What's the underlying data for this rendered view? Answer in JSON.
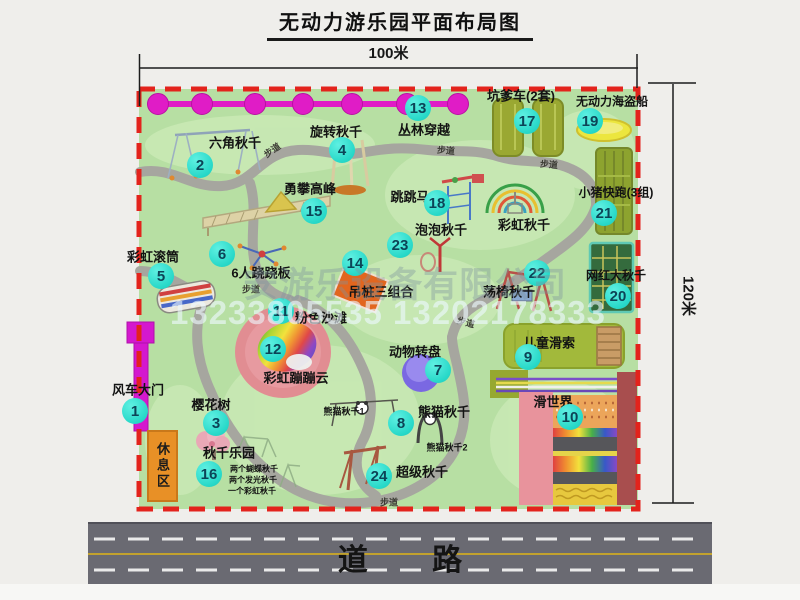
{
  "title": "无动力游乐园平面布局图",
  "dimensions": {
    "width_label": "100米",
    "height_label": "120米"
  },
  "road_label": "道 路",
  "rest_area_label": "休息区",
  "watermark": {
    "company": "安游乐设备有限公司",
    "phone": "13233805535 13202178333"
  },
  "map": {
    "markers": [
      {
        "num": "1",
        "x": 135,
        "y": 411
      },
      {
        "num": "2",
        "x": 200,
        "y": 165
      },
      {
        "num": "3",
        "x": 216,
        "y": 423
      },
      {
        "num": "4",
        "x": 342,
        "y": 150
      },
      {
        "num": "5",
        "x": 161,
        "y": 276
      },
      {
        "num": "6",
        "x": 222,
        "y": 254
      },
      {
        "num": "7",
        "x": 438,
        "y": 370
      },
      {
        "num": "8",
        "x": 401,
        "y": 423
      },
      {
        "num": "9",
        "x": 528,
        "y": 357
      },
      {
        "num": "10",
        "x": 570,
        "y": 417
      },
      {
        "num": "11",
        "x": 281,
        "y": 311
      },
      {
        "num": "12",
        "x": 273,
        "y": 349
      },
      {
        "num": "13",
        "x": 418,
        "y": 108
      },
      {
        "num": "14",
        "x": 355,
        "y": 263
      },
      {
        "num": "15",
        "x": 314,
        "y": 211
      },
      {
        "num": "16",
        "x": 209,
        "y": 474
      },
      {
        "num": "17",
        "x": 527,
        "y": 121
      },
      {
        "num": "18",
        "x": 437,
        "y": 203
      },
      {
        "num": "19",
        "x": 590,
        "y": 121
      },
      {
        "num": "20",
        "x": 618,
        "y": 296
      },
      {
        "num": "21",
        "x": 604,
        "y": 213
      },
      {
        "num": "22",
        "x": 537,
        "y": 273
      },
      {
        "num": "23",
        "x": 400,
        "y": 245
      },
      {
        "num": "24",
        "x": 379,
        "y": 476
      }
    ],
    "labels": [
      {
        "text": "六角秋千",
        "x": 235,
        "y": 142
      },
      {
        "text": "旋转秋千",
        "x": 336,
        "y": 131
      },
      {
        "text": "丛林穿越",
        "x": 424,
        "y": 129
      },
      {
        "text": "坑爹车(2套)",
        "x": 521,
        "y": 95
      },
      {
        "text": "无动力海盗船",
        "x": 612,
        "y": 101,
        "size": 12
      },
      {
        "text": "勇攀高峰",
        "x": 310,
        "y": 188
      },
      {
        "text": "跳跳马",
        "x": 410,
        "y": 196
      },
      {
        "text": "小猪快跑(3组)",
        "x": 616,
        "y": 192,
        "size": 12
      },
      {
        "text": "泡泡秋千",
        "x": 441,
        "y": 229
      },
      {
        "text": "彩虹秋千",
        "x": 524,
        "y": 224
      },
      {
        "text": "彩虹滚筒",
        "x": 153,
        "y": 256
      },
      {
        "text": "6人跷跷板",
        "x": 261,
        "y": 272
      },
      {
        "text": "吊桩三组合",
        "x": 381,
        "y": 291
      },
      {
        "text": "荡椅秋千",
        "x": 509,
        "y": 291
      },
      {
        "text": "网红大秋千",
        "x": 616,
        "y": 275,
        "size": 12
      },
      {
        "text": "粉色沙滩",
        "x": 321,
        "y": 317
      },
      {
        "text": "彩虹蹦蹦云",
        "x": 296,
        "y": 377
      },
      {
        "text": "动物转盘",
        "x": 415,
        "y": 351
      },
      {
        "text": "儿童滑索",
        "x": 549,
        "y": 342
      },
      {
        "text": "滑世界",
        "x": 553,
        "y": 401
      },
      {
        "text": "风车大门",
        "x": 138,
        "y": 389
      },
      {
        "text": "樱花树",
        "x": 211,
        "y": 404
      },
      {
        "text": "秋千乐园",
        "x": 229,
        "y": 452
      },
      {
        "text": "熊猫秋千",
        "x": 444,
        "y": 411
      },
      {
        "text": "超级秋千",
        "x": 422,
        "y": 471
      },
      {
        "text": "熊猫秋千1",
        "x": 344,
        "y": 411,
        "size": 9
      },
      {
        "text": "熊猫秋千2",
        "x": 447,
        "y": 447,
        "size": 9
      },
      {
        "text": "两个蝴蝶秋千",
        "x": 254,
        "y": 469,
        "size": 8
      },
      {
        "text": "两个发光秋千",
        "x": 253,
        "y": 480,
        "size": 8
      },
      {
        "text": "一个彩虹秋千",
        "x": 252,
        "y": 491,
        "size": 8
      },
      {
        "text": "步道",
        "x": 272,
        "y": 150,
        "size": 9,
        "rot": -35,
        "color": "#3c3c35"
      },
      {
        "text": "步道",
        "x": 446,
        "y": 150,
        "size": 9,
        "rot": 5,
        "color": "#3c3c35"
      },
      {
        "text": "步道",
        "x": 549,
        "y": 164,
        "size": 9,
        "rot": 5,
        "color": "#3c3c35"
      },
      {
        "text": "步道",
        "x": 251,
        "y": 289,
        "size": 9,
        "rot": 0,
        "color": "#3c3c35"
      },
      {
        "text": "步道",
        "x": 466,
        "y": 322,
        "size": 9,
        "rot": 15,
        "color": "#3c3c35"
      },
      {
        "text": "步道",
        "x": 389,
        "y": 502,
        "size": 9,
        "rot": 0,
        "color": "#3c3c35"
      }
    ]
  }
}
